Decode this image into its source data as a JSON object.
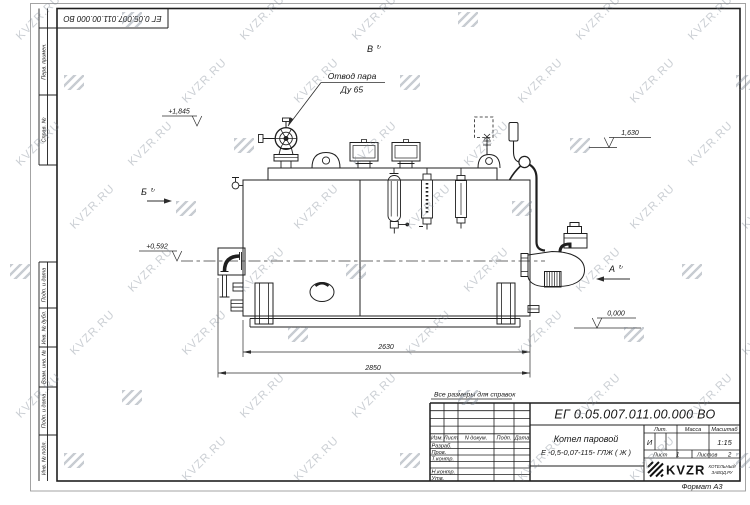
{
  "sheet": {
    "top_stamp": "ЕГ 0.05.007.011.00.000  ВО",
    "note": "Все размеры для справок",
    "format_label": "Формат А3"
  },
  "watermark": {
    "text": "KVZR.RU"
  },
  "margin_fields": {
    "f1": "Перв. примен.",
    "f2": "Справ. №",
    "f3": "Подп. и дата",
    "f4": "Инв. № дубл.",
    "f5": "Взам. инв. №",
    "f6": "Подп. и дата",
    "f7": "Инв. № подл."
  },
  "drawing": {
    "steam_label_1": "Отвод пара",
    "steam_label_2": "Ду 65",
    "view_b": "Б",
    "view_v": "В",
    "view_a": "А",
    "rotated_mark": "↻",
    "elev_1845": "+1,845",
    "elev_1630": "1,630",
    "elev_0592": "+0,592",
    "elev_0000": "0,000",
    "dim_2630": "2630",
    "dim_2850": "2850"
  },
  "title_block": {
    "doc_number": "ЕГ 0.05.007.011.00.000  ВО",
    "product_line1": "Котел паровой",
    "product_line2": "Е -0,5-0,07-115- ГЛЖ ( Ж )",
    "col_izm": "Изм.",
    "col_list": "Лист",
    "col_doc": "N докум.",
    "col_podp": "Подп.",
    "col_data": "Дата",
    "row_razrab": "Разраб.",
    "row_prov": "Пров.",
    "row_tkontr": "Т.контр.",
    "row_nkontr": "Н.контр.",
    "row_utv": "Утв.",
    "lit_label": "Лит.",
    "mass_label": "Масса",
    "scale_label": "Масштаб",
    "lit_value": "И",
    "scale_value": "1:15",
    "sheet_label": "Лист",
    "sheet_num": "1",
    "sheets_label": "Листов",
    "sheets_num": "2",
    "brand": "KVZR",
    "brand_sub1": "КОТЕЛЬНЫЙ",
    "brand_sub2": "ЗАВОД.РУ"
  }
}
